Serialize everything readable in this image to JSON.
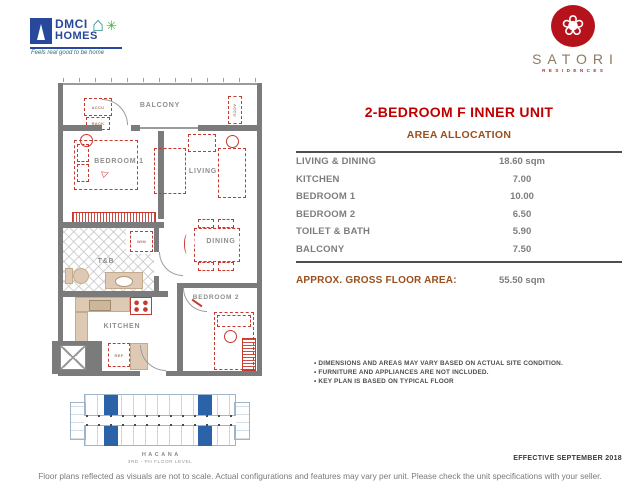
{
  "branding": {
    "dmci": {
      "line1": "DMCI",
      "line2": "HOMES",
      "tagline": "Feels real good to be home",
      "house_icon": "⌂",
      "splash_icon": "✳"
    },
    "satori": {
      "name": "SATORI",
      "sub": "RESIDENCES",
      "flower_icon": "❀"
    }
  },
  "unit": {
    "title": "2-BEDROOM F INNER UNIT",
    "section_title": "AREA ALLOCATION",
    "areas": [
      {
        "label": "LIVING & DINING",
        "value": "18.60 sqm"
      },
      {
        "label": "KITCHEN",
        "value": "7.00"
      },
      {
        "label": "BEDROOM 1",
        "value": "10.00"
      },
      {
        "label": "BEDROOM 2",
        "value": "6.50"
      },
      {
        "label": "TOILET & BATH",
        "value": "5.90"
      },
      {
        "label": "BALCONY",
        "value": "7.50"
      }
    ],
    "gross_label": "APPROX. GROSS FLOOR AREA:",
    "gross_value": "55.50 sqm"
  },
  "notes": [
    "DIMENSIONS AND AREAS MAY VARY BASED ON ACTUAL SITE CONDITION.",
    "FURNITURE AND APPLIANCES ARE NOT INCLUDED.",
    "KEY PLAN IS BASED ON TYPICAL FLOOR"
  ],
  "floor_plan": {
    "labels": {
      "balcony": "BALCONY",
      "bedroom1": "BEDROOM 1",
      "living": "LIVING",
      "dining": "DINING",
      "toilet_bath": "T&B",
      "kitchen": "KITCHEN",
      "bedroom2": "BEDROOM 2"
    },
    "equip": {
      "accu": "ACCU",
      "rack": "RACK",
      "wm": "W/M",
      "ref": "REF"
    }
  },
  "key_plan": {
    "building_name": "HACANA",
    "level": "3RD - PH FLOOR LEVEL"
  },
  "effective_label": "EFFECTIVE SEPTEMBER 2018",
  "footer_note": "Floor plans reflected as visuals are not to scale. Actual configurations and features may vary per unit. Please check the unit specifications with your seller.",
  "colors": {
    "accent_red": "#c00000",
    "accent_brown": "#9a4f1d",
    "wall_gray": "#7b7b7b",
    "furniture_red": "#c5392f",
    "fixture_beige": "#ddc9b4",
    "keyplan_blue": "#2b62a8",
    "logo_blue": "#27489c",
    "logo_red": "#b5121b"
  }
}
